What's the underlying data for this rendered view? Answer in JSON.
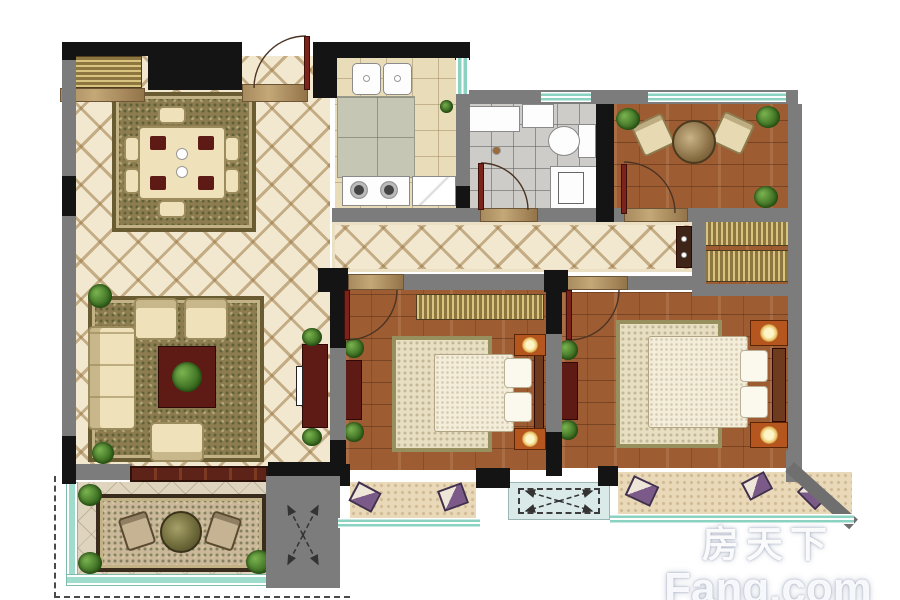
{
  "meta": {
    "kind": "apartment-floor-plan",
    "width_px": 900,
    "height_px": 600
  },
  "watermark": {
    "brand_cn": "房天下",
    "brand_en": "Fang.com"
  },
  "colors": {
    "wall": "#7c7c7c",
    "pier": "#141414",
    "glass": "#8bd3c0",
    "door": "#7a241b",
    "wood": "#9e5c33",
    "lattice_bg": "#f2e8d0",
    "bath_tile": "#cdccc8",
    "kitchen_floor": "#e9dcb8",
    "rug_olive": "#8c7c50",
    "cream": "#efe2ba",
    "dark_red": "#5e1a14",
    "nightstand": "#b4561e",
    "bay_fluff": "#ead9b8",
    "shaft_blue": "#d9eae8",
    "balcony_glass": "#9fdccb"
  },
  "rooms": [
    {
      "id": "living-dining-room",
      "furniture": [
        "sideboard",
        "dining-table",
        "dining-chairs",
        "dining-rug",
        "sofa",
        "armchairs",
        "coffee-table",
        "tv-cabinet",
        "plants"
      ]
    },
    {
      "id": "kitchen",
      "furniture": [
        "double-sink",
        "counter",
        "gas-stove",
        "refrigerator"
      ]
    },
    {
      "id": "bathroom",
      "furniture": [
        "washer-counter",
        "toilet",
        "vanity-sink",
        "floor-drain",
        "door"
      ]
    },
    {
      "id": "leisure-room",
      "furniture": [
        "two-armchairs",
        "round-tea-table",
        "plants",
        "door",
        "wardrobe-cabinets"
      ]
    },
    {
      "id": "corridor",
      "furniture": [
        "end-cabinet"
      ]
    },
    {
      "id": "bedroom-middle",
      "furniture": [
        "wardrobe",
        "double-bed",
        "nightstand-lamps",
        "dresser",
        "plants",
        "door",
        "bay-window-cushions"
      ]
    },
    {
      "id": "bedroom-master",
      "furniture": [
        "double-bed",
        "nightstand-lamps",
        "dresser",
        "plants",
        "door",
        "bay-window-cushions"
      ]
    },
    {
      "id": "balcony",
      "furniture": [
        "tea-table",
        "two-chairs",
        "rug",
        "corner-plants"
      ]
    },
    {
      "id": "ac-platforms",
      "furniture": [
        "dashed-x-shaft-symbol"
      ]
    }
  ]
}
